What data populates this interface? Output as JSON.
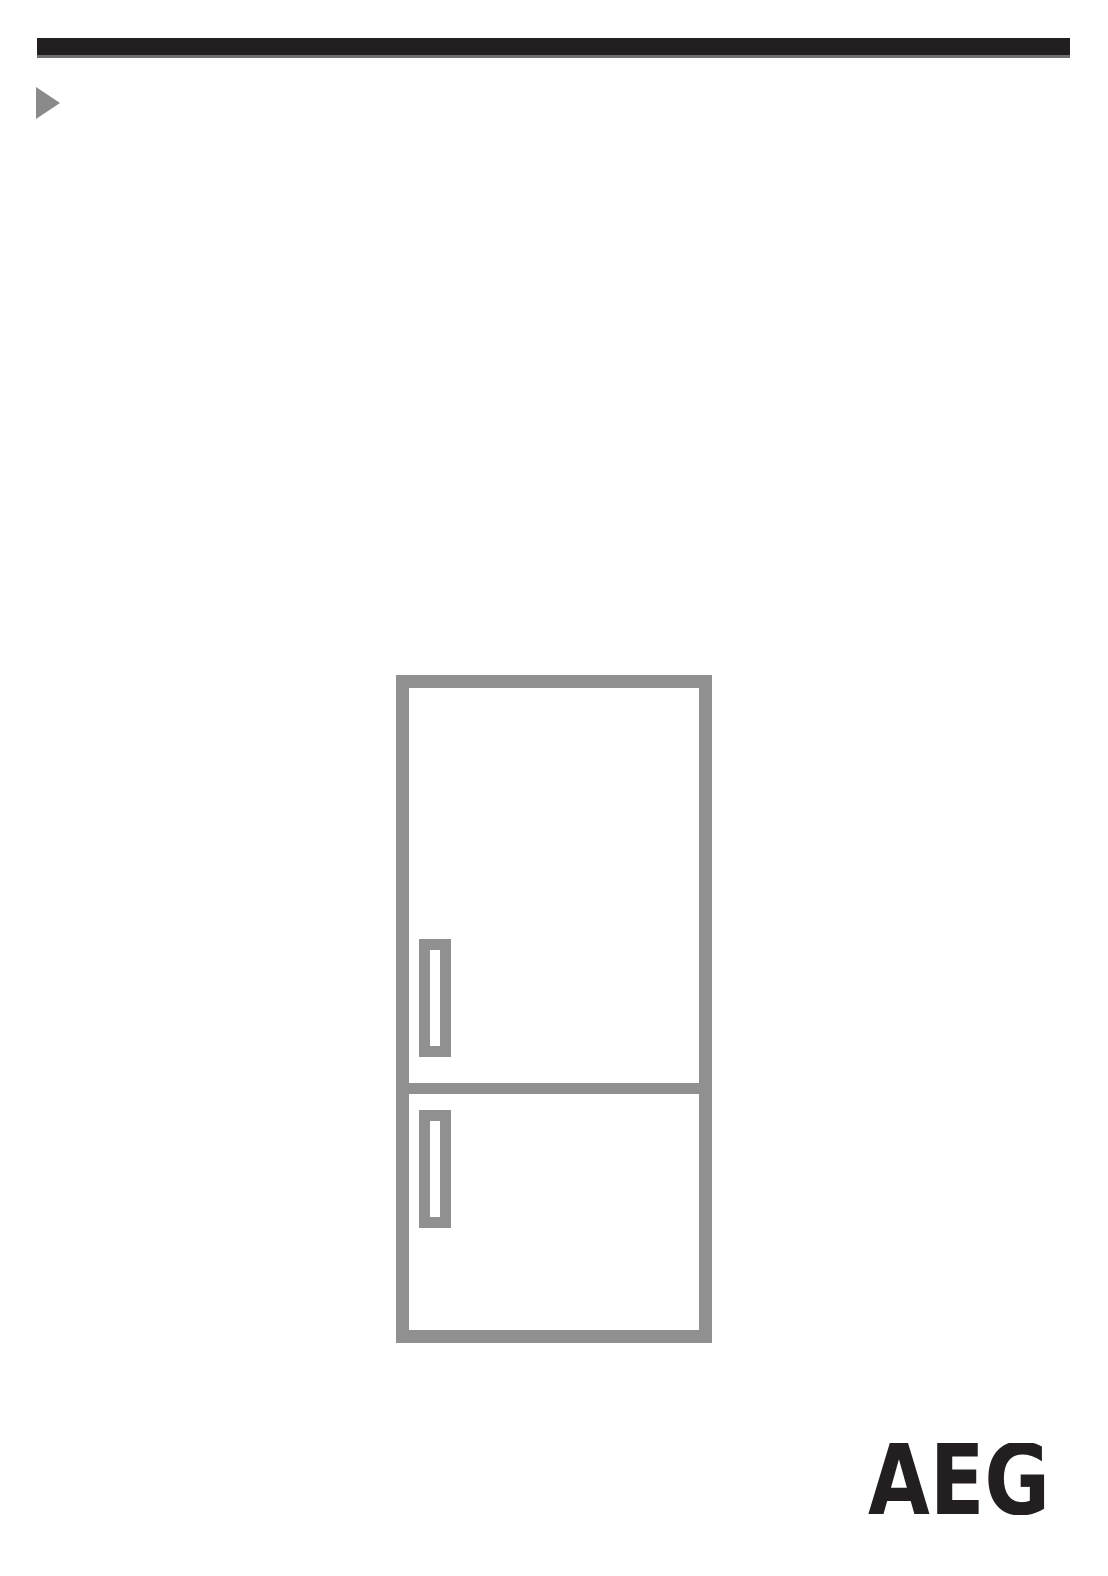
{
  "page": {
    "background_color": "#ffffff"
  },
  "header": {
    "bar_color": "#231f20",
    "bar_underline_color": "#6f6f6f",
    "bullet_icon": "right-triangle-icon",
    "bullet_color": "#8a8a8a"
  },
  "figure": {
    "icon": "fridge-freezer-outline",
    "line_color": "#909090",
    "doors": "2",
    "handles": "2"
  },
  "brand": {
    "logo_text": "AEG",
    "logo_color": "#231f20"
  }
}
